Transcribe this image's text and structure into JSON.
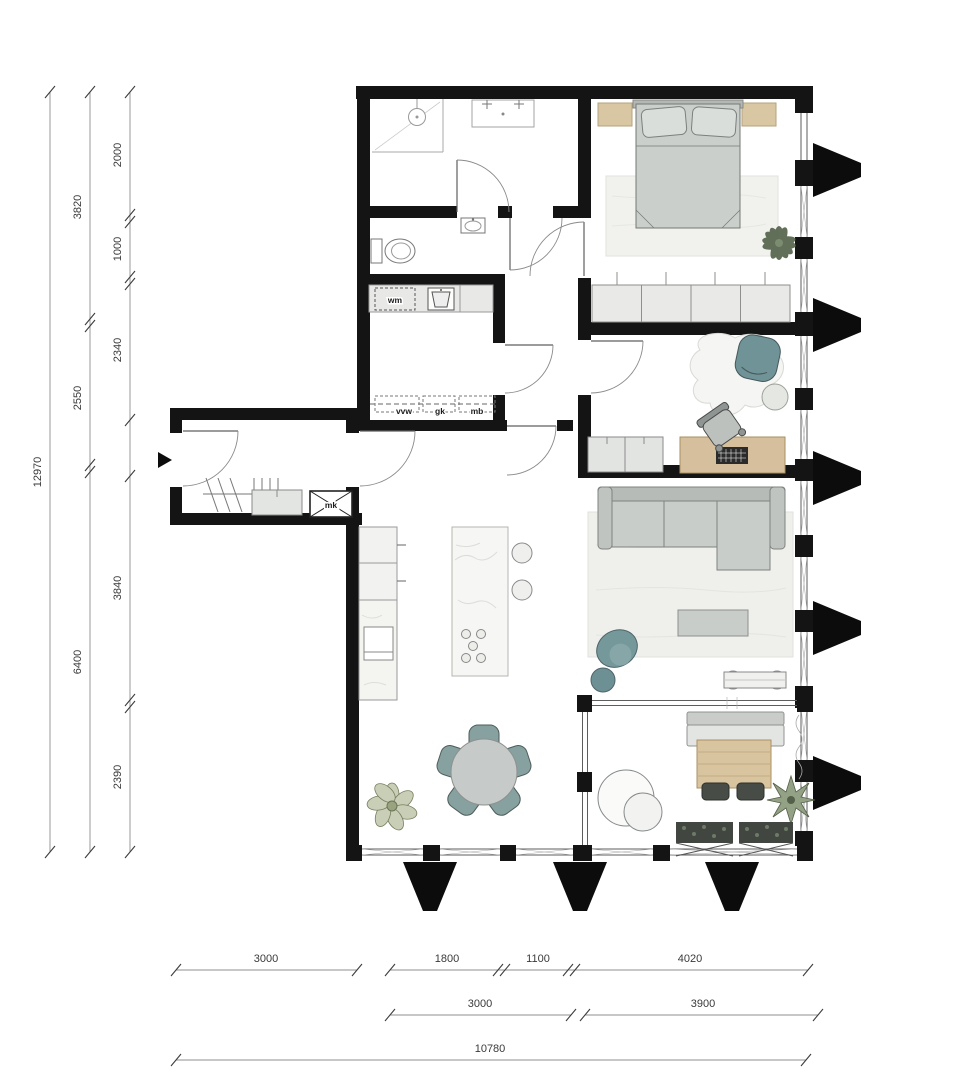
{
  "meta": {
    "type": "architectural floor plan",
    "units": "mm"
  },
  "colors": {
    "wall": "#141414",
    "teal_furniture": "#7d9a9b",
    "wood": "#d5bf9c",
    "gray_furniture": "#c6cac8",
    "rug": "#efefec",
    "plant_dark": "#55644d"
  },
  "labels": {
    "wm": "wm",
    "vvw": "vvw",
    "gk": "gk",
    "mb": "mb",
    "mk": "mk"
  },
  "dimensions": {
    "left_outer_total": "12970",
    "left_middle": [
      "3820",
      "2550",
      "6400"
    ],
    "left_inner": [
      "2000",
      "1000",
      "2340",
      "3840",
      "2390"
    ],
    "bottom_top_left": "3000",
    "bottom_top": [
      "1800",
      "1100",
      "4020"
    ],
    "bottom_middle": [
      "3000",
      "3900"
    ],
    "bottom_total": "10780"
  }
}
